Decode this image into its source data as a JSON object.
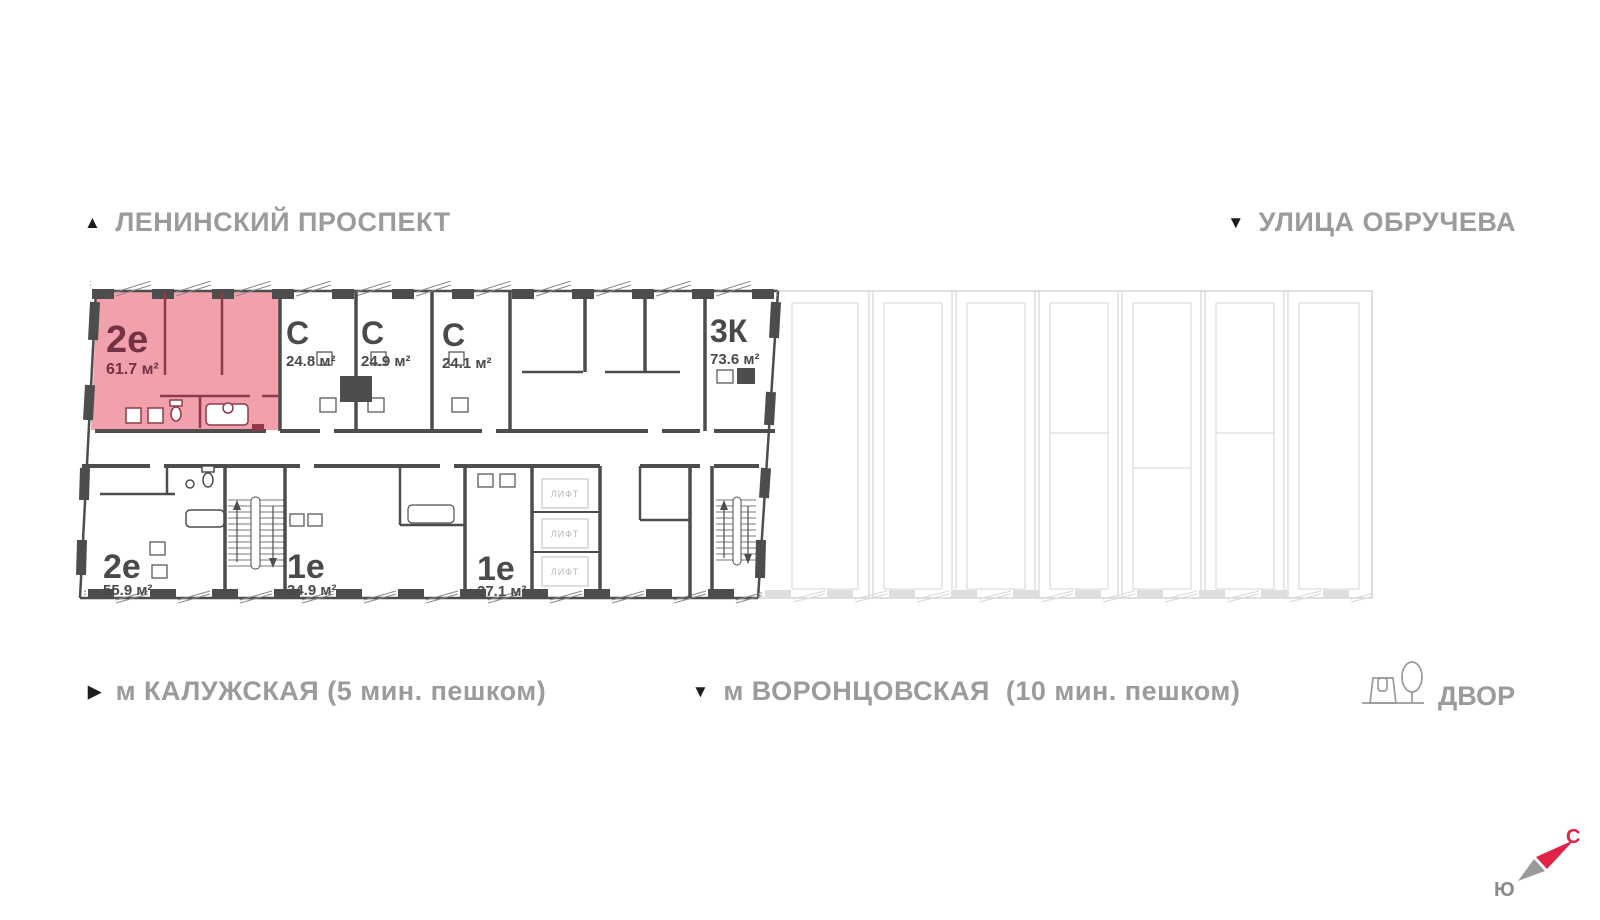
{
  "streets": {
    "top_left": {
      "icon": "▲",
      "label": "ЛЕНИНСКИЙ ПРОСПЕКТ"
    },
    "top_right": {
      "icon": "▼",
      "label": "УЛИЦА ОБРУЧЕВА"
    }
  },
  "transit": {
    "metro_kaluzhskaya": {
      "icon": "▶",
      "label": "м КАЛУЖСКАЯ (5 мин. пешком)"
    },
    "metro_vorontsovskaya": {
      "icon": "▼",
      "label": "м ВОРОНЦОВСКАЯ  (10 мин. пешком)"
    },
    "courtyard": {
      "label": "ДВОР"
    }
  },
  "compass": {
    "north_label": "С",
    "south_label": "Ю",
    "north_color": "#e02447",
    "south_color": "#8a8a8a"
  },
  "floor_plan": {
    "units": [
      {
        "id": "unit-2e-61-7",
        "type": "2е",
        "area": "61.7 м²",
        "highlighted": true
      },
      {
        "id": "unit-s-24-8",
        "type": "С",
        "area": "24.8 м²",
        "highlighted": false
      },
      {
        "id": "unit-s-24-9",
        "type": "С",
        "area": "24.9 м²",
        "highlighted": false
      },
      {
        "id": "unit-s-24-1",
        "type": "С",
        "area": "24.1 м²",
        "highlighted": false
      },
      {
        "id": "unit-3k-73-6",
        "type": "3К",
        "area": "73.6 м²",
        "highlighted": false
      },
      {
        "id": "unit-2e-55-9",
        "type": "2е",
        "area": "55.9 м²",
        "highlighted": false
      },
      {
        "id": "unit-1e-34-9",
        "type": "1е",
        "area": "34.9 м²",
        "highlighted": false
      },
      {
        "id": "unit-1e-37-1",
        "type": "1е",
        "area": "37.1 м²",
        "highlighted": false
      }
    ],
    "elevator_label": "ЛИФТ",
    "colors": {
      "highlight_fill": "#f2a0ac",
      "highlight_wall": "#8e3a4a",
      "highlight_text": "#753244",
      "wall": "#4d4d4d",
      "faint": "#cdcdcd",
      "lift_text": "#b9b9b9"
    }
  }
}
